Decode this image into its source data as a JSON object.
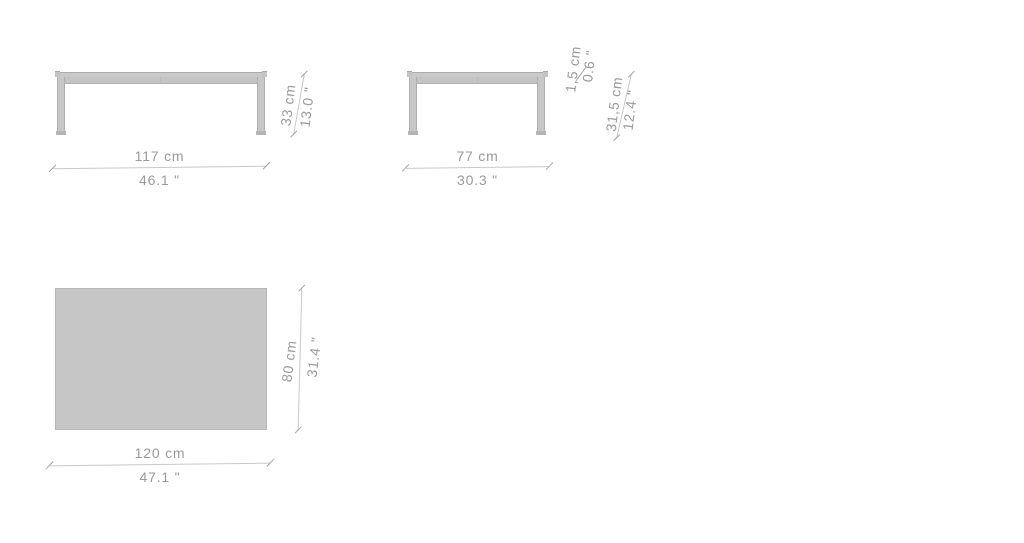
{
  "drawing": {
    "type": "furniture-dimension-diagram",
    "views": {
      "front": {
        "width_cm": "117 cm",
        "width_in": "46.1 \"",
        "height_cm": "33 cm",
        "height_in": "13.0 \""
      },
      "side": {
        "width_cm": "77 cm",
        "width_in": "30.3 \"",
        "top_thickness_cm": "1,5 cm",
        "top_thickness_in": "0.6 \"",
        "leg_height_cm": "31,5 cm",
        "leg_height_in": "12.4 \""
      },
      "top": {
        "width_cm": "120 cm",
        "width_in": "47.1 \"",
        "depth_cm": "80 cm",
        "depth_in": "31.4 \""
      }
    },
    "colors": {
      "background": "#ffffff",
      "fill_light": "#cacaca",
      "fill_mid": "#c4c4c4",
      "rect_fill": "#c6c6c6",
      "edge": "#ababab",
      "dim_line": "#c9c9c9",
      "dim_tick": "#a6a6a6",
      "dim_text": "#9a9a9a"
    }
  }
}
